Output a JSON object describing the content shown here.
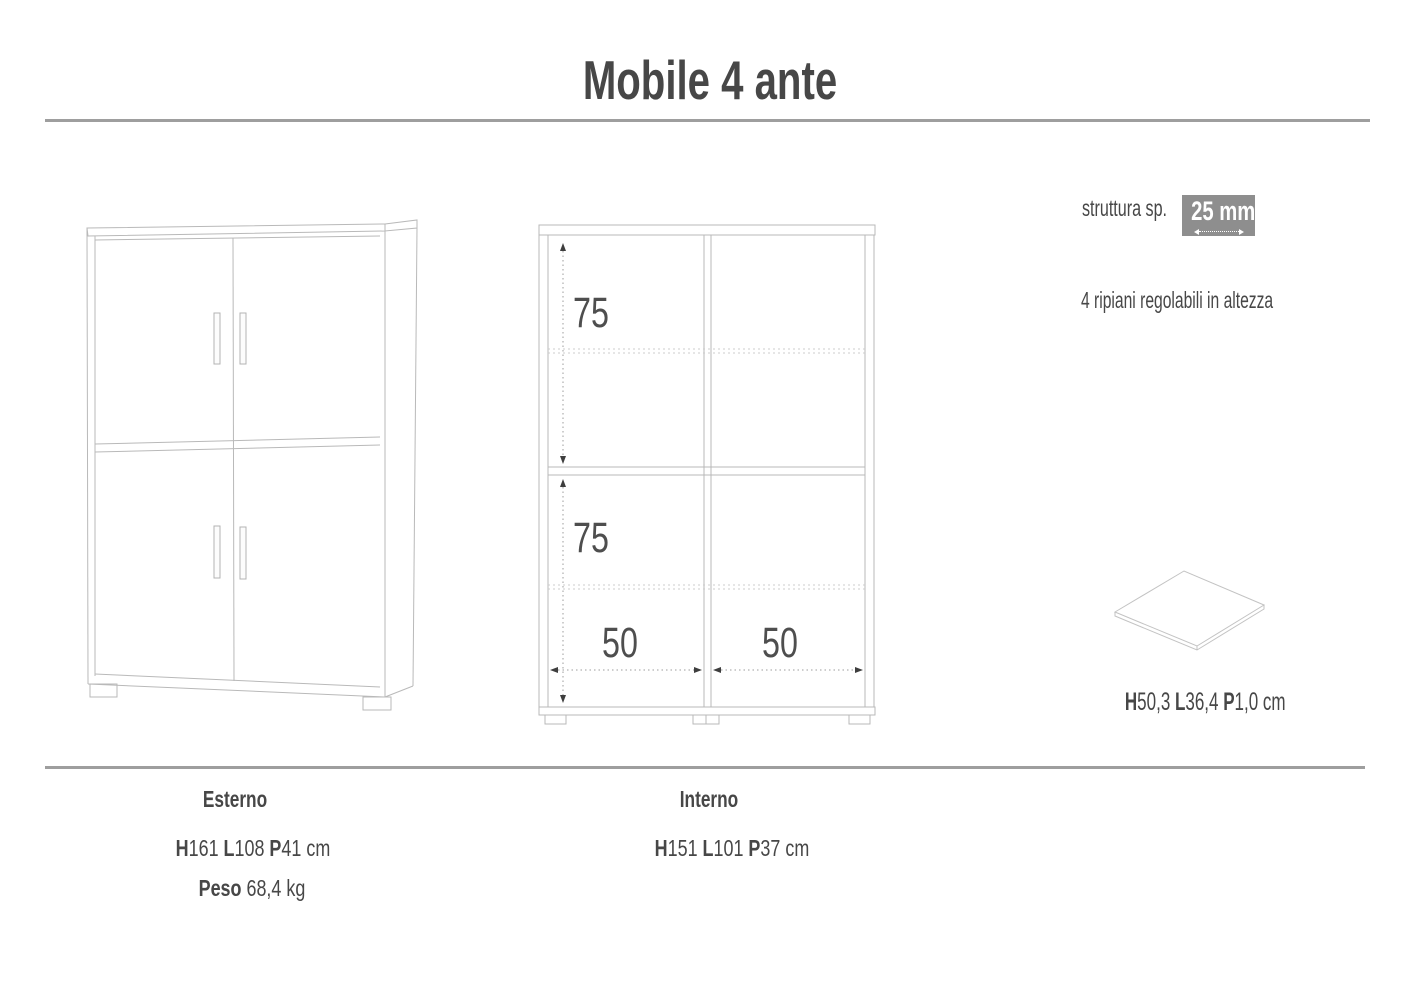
{
  "title": "Mobile 4 ante",
  "specs": {
    "thickness_label": "struttura sp.",
    "thickness_value": "25 mm",
    "shelves_note": "4 ripiani regolabili in altezza",
    "shelf_dims": {
      "segments": [
        {
          "t": "H"
        },
        {
          "t": "50,3 "
        },
        {
          "t": "L"
        },
        {
          "t": "36,4 "
        },
        {
          "t": "P"
        },
        {
          "t": "1,0 "
        },
        {
          "t": "cm"
        }
      ]
    }
  },
  "interior": {
    "upper_height": "75",
    "lower_height": "75",
    "left_width": "50",
    "right_width": "50"
  },
  "footer": {
    "esterno": {
      "heading": "Esterno",
      "dims": {
        "segments": [
          {
            "t": "H"
          },
          {
            "t": "161 "
          },
          {
            "t": "L"
          },
          {
            "t": "108 "
          },
          {
            "t": "P"
          },
          {
            "t": "41 "
          },
          {
            "t": "cm"
          }
        ]
      },
      "weight_label": "Peso",
      "weight_value": " 68,4 kg"
    },
    "interno": {
      "heading": "Interno",
      "dims": {
        "segments": [
          {
            "t": "H"
          },
          {
            "t": "151 "
          },
          {
            "t": "L"
          },
          {
            "t": "101 "
          },
          {
            "t": "P"
          },
          {
            "t": "37 "
          },
          {
            "t": "cm"
          }
        ]
      }
    }
  }
}
